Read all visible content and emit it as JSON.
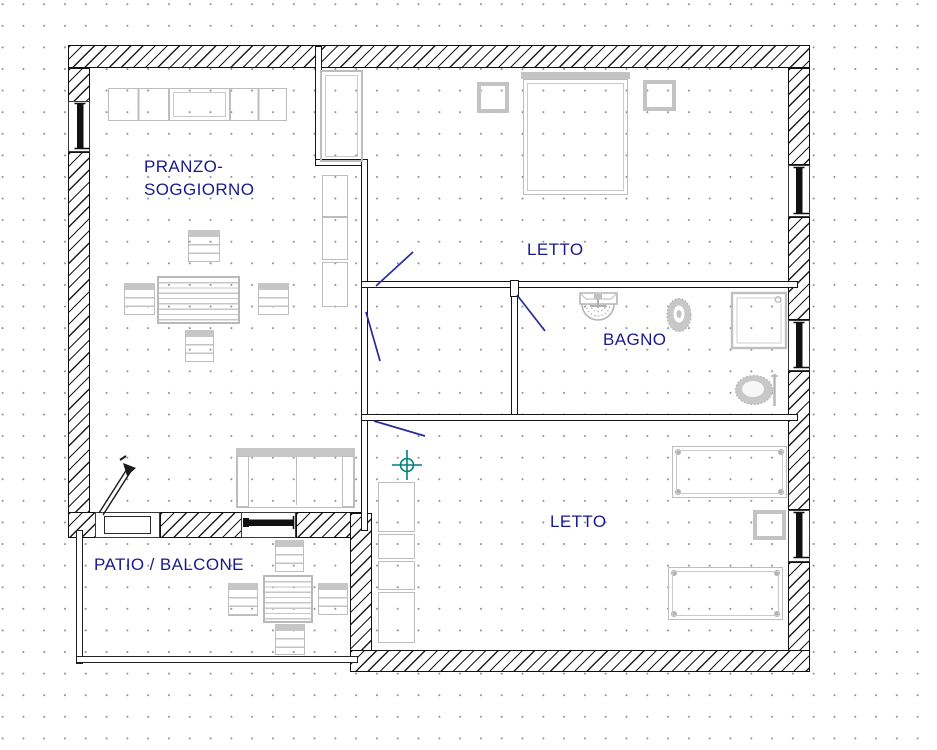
{
  "plan": {
    "title": "apartment floor plan",
    "labels": {
      "living_line1": "PRANZO-",
      "living_line2": "SOGGIORNO",
      "bedroom1": "LETTO",
      "bathroom": "BAGNO",
      "bedroom2": "LETTO",
      "patio": "PATIO / BALCONE"
    },
    "colors": {
      "wall_line": "#111111",
      "furniture_line": "#bdbdbd",
      "label_text": "#1a1a8e",
      "door_swing": "#2a2a99",
      "reference_marker": "#007f7f",
      "grid_dot": "#8791a3",
      "window_glass": "#111111"
    }
  }
}
